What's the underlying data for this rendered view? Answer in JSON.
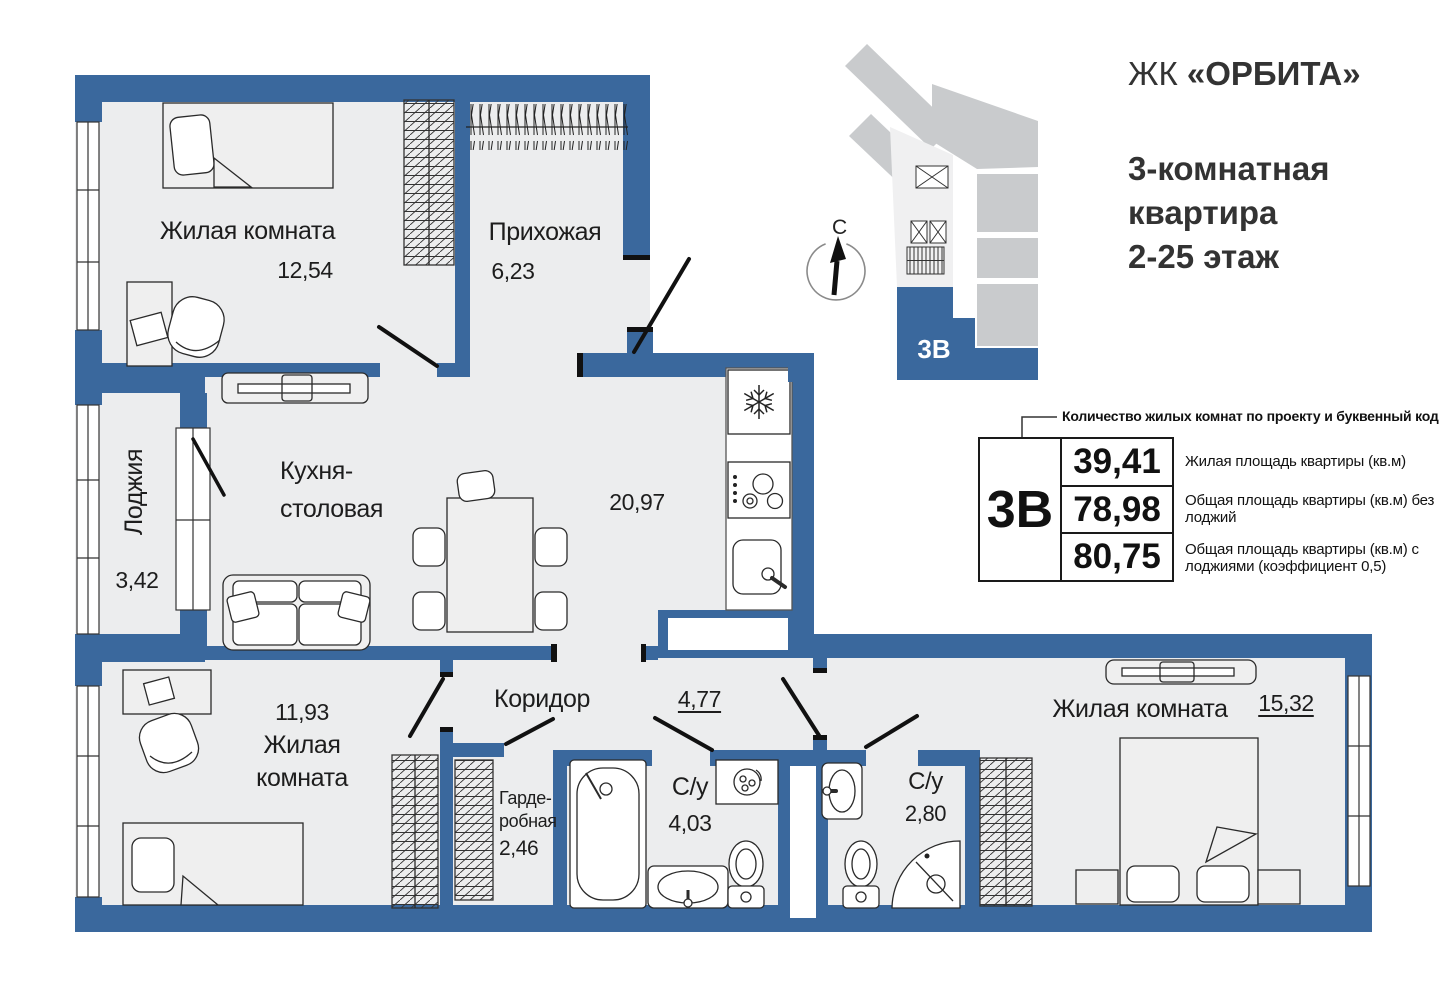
{
  "header": {
    "complex_prefix": "ЖК",
    "complex_name": "«ОРБИТА»",
    "subtitle_line1": "3-комнатная",
    "subtitle_line2": "квартира",
    "subtitle_line3": "2-25 этаж"
  },
  "locator": {
    "unit_code": "3В",
    "compass_north": "С"
  },
  "info_table": {
    "callout": "Количество жилых комнат по проекту и буквенный код",
    "code": "3В",
    "rows": [
      {
        "value": "39,41",
        "description": "Жилая площадь квартиры (кв.м)"
      },
      {
        "value": "78,98",
        "description": "Общая площадь квартиры (кв.м) без лоджий"
      },
      {
        "value": "80,75",
        "description": "Общая площадь квартиры (кв.м) с лоджиями (коэффициент 0,5)"
      }
    ]
  },
  "rooms": {
    "bedroom1": {
      "label": "Жилая комната",
      "area": "12,54"
    },
    "hallway": {
      "label": "Прихожая",
      "area": "6,23"
    },
    "loggia": {
      "label": "Лоджия",
      "area": "3,42"
    },
    "kitchen": {
      "label_line1": "Кухня-",
      "label_line2": "столовая",
      "area": "20,97"
    },
    "corridor": {
      "label": "Коридор",
      "area": "4,77"
    },
    "bedroom2": {
      "area": "11,93",
      "label_line1": "Жилая",
      "label_line2": "комната"
    },
    "wardrobe_room": {
      "label_line1": "Гарде-",
      "label_line2": "робная",
      "area": "2,46"
    },
    "bath1": {
      "label": "С/у",
      "area": "4,03"
    },
    "bath2": {
      "label": "С/у",
      "area": "2,80"
    },
    "bedroom3": {
      "label": "Жилая комната",
      "area": "15,32"
    }
  },
  "colors": {
    "wall_blue": "#3A689D",
    "room_fill": "#ECEDEE",
    "building_gray": "#C9CBCD",
    "core_gray": "#F0F0F1"
  }
}
